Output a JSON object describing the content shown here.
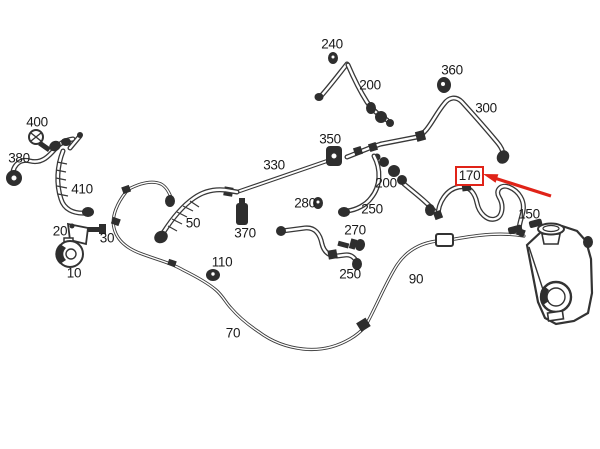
{
  "diagram": {
    "type": "parts-diagram",
    "subject": "cooling system hoses and pipes routing",
    "colors": {
      "background": "#ffffff",
      "line": "#383838",
      "label": "#1a1a1a",
      "highlight": "#e02318"
    },
    "labels": [
      {
        "text": "240",
        "x": 332,
        "y": 44
      },
      {
        "text": "200",
        "x": 370,
        "y": 85
      },
      {
        "text": "360",
        "x": 452,
        "y": 70
      },
      {
        "text": "300",
        "x": 486,
        "y": 108
      },
      {
        "text": "400",
        "x": 37,
        "y": 122
      },
      {
        "text": "380",
        "x": 19,
        "y": 158
      },
      {
        "text": "350",
        "x": 330,
        "y": 139
      },
      {
        "text": "330",
        "x": 274,
        "y": 165
      },
      {
        "text": "410",
        "x": 82,
        "y": 189
      },
      {
        "text": "200",
        "x": 386,
        "y": 183
      },
      {
        "text": "280",
        "x": 305,
        "y": 203
      },
      {
        "text": "250",
        "x": 372,
        "y": 209
      },
      {
        "text": "150",
        "x": 529,
        "y": 214
      },
      {
        "text": "50",
        "x": 193,
        "y": 223
      },
      {
        "text": "20",
        "x": 60,
        "y": 231
      },
      {
        "text": "370",
        "x": 245,
        "y": 233
      },
      {
        "text": "270",
        "x": 355,
        "y": 230
      },
      {
        "text": "30",
        "x": 107,
        "y": 238
      },
      {
        "text": "110",
        "x": 222,
        "y": 262
      },
      {
        "text": "10",
        "x": 74,
        "y": 273
      },
      {
        "text": "250",
        "x": 350,
        "y": 274
      },
      {
        "text": "90",
        "x": 416,
        "y": 279
      },
      {
        "text": "70",
        "x": 233,
        "y": 333
      }
    ],
    "highlight": {
      "part": "170",
      "color": "#e02318",
      "box": {
        "x": 455,
        "y": 166,
        "w": 29,
        "h": 20
      },
      "arrow": {
        "tail_x": 551,
        "tail_y": 196,
        "tip_x": 483,
        "tip_y": 174
      }
    }
  }
}
